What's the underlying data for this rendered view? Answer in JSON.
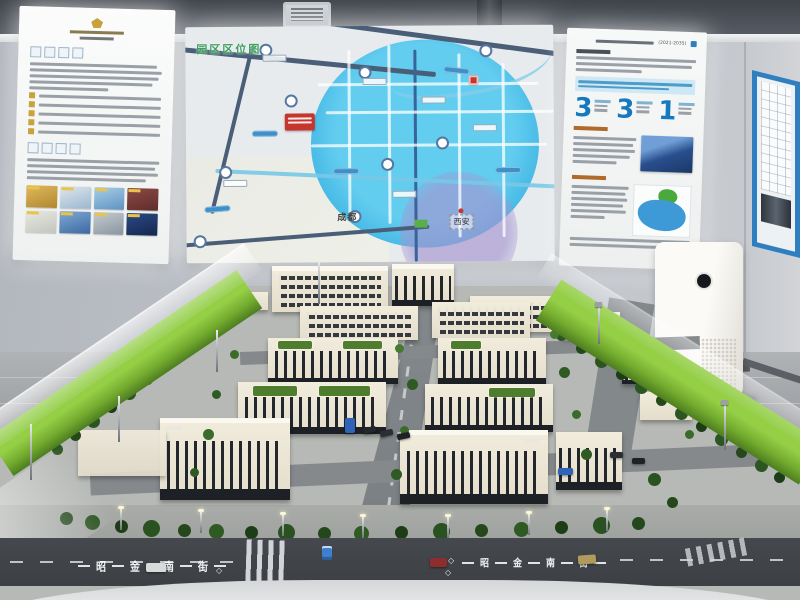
{
  "scene": {
    "description": "Showroom with an architectural scale model table surrounded by glass railing, three backlit information panels on the wall, a blue-framed poster on the side wall and a white air purifier on the floor"
  },
  "panels": {
    "map": {
      "title": "园区区位图",
      "city_center": "成都",
      "city_right": "西安"
    },
    "right": {
      "plan_period": "(2021-2035)",
      "stats": [
        {
          "value": "3"
        },
        {
          "value": "3"
        },
        {
          "value": "1"
        }
      ]
    }
  },
  "model": {
    "street_name": "昭金南街",
    "street_chars": [
      "昭",
      "金",
      "南",
      "街"
    ],
    "lane_diamond": "◇"
  },
  "colors": {
    "accent_blue": "#1779bd",
    "map_circle_blue": "#3fb4e2",
    "lawn_green": "#7fb83a",
    "marker_red": "#c5372e"
  },
  "icons": {
    "ceiling_vent": "vent-icon",
    "bus_stop": "bus-stop-icon",
    "air_purifier_display": "power-dial-icon"
  }
}
